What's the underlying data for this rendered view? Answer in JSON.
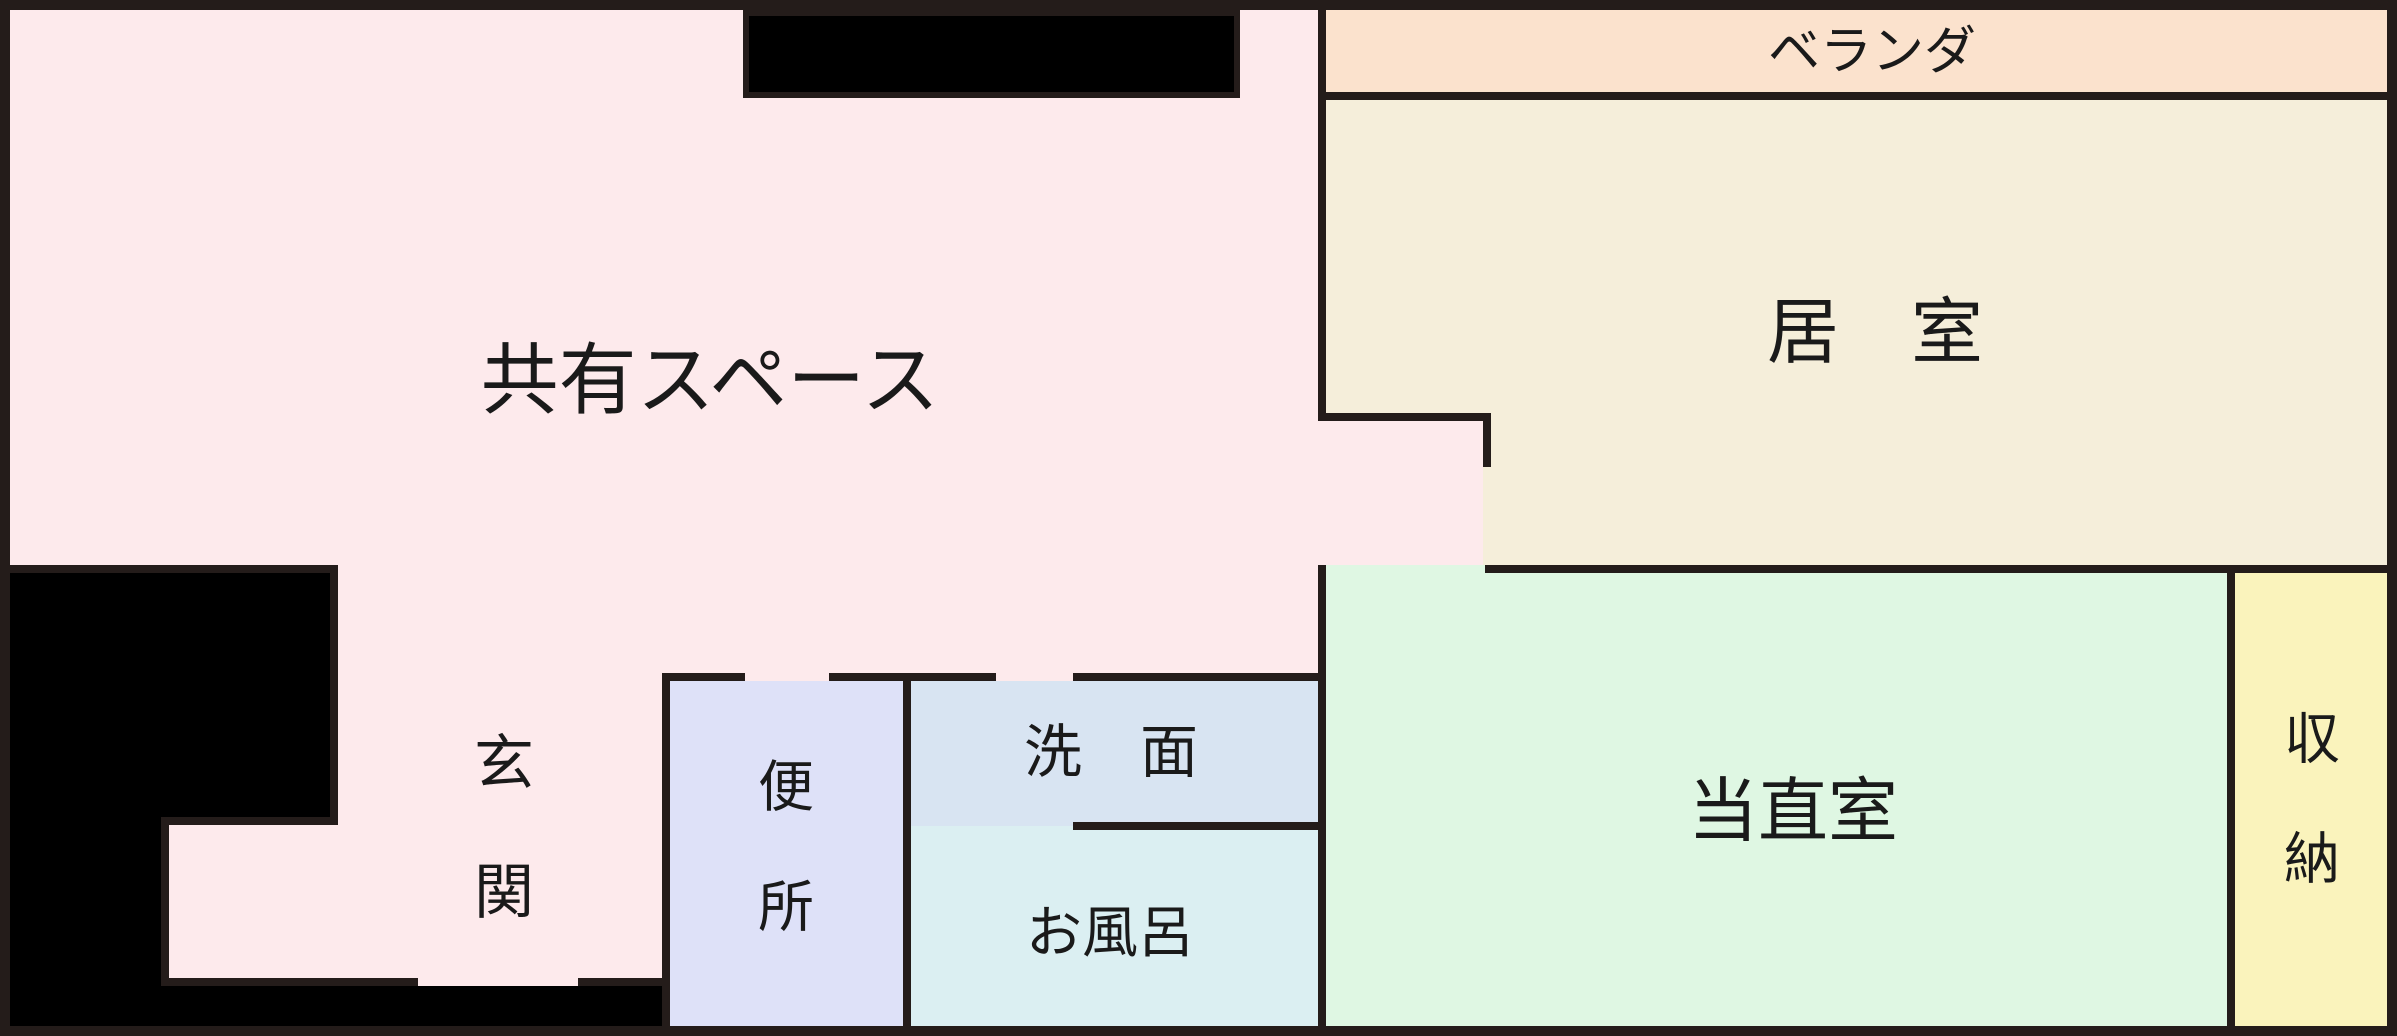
{
  "plan_title": "floor-plan",
  "rooms": {
    "shared_space": {
      "label": "共有スペース",
      "color": "#fdeaec"
    },
    "veranda": {
      "label": "ベランダ",
      "color": "#fbe2cd"
    },
    "living_room": {
      "label": "居　室",
      "color": "#f5eeda"
    },
    "duty_room": {
      "label": "当直室",
      "color": "#dff7e3"
    },
    "storage": {
      "label": "収納",
      "color": "#faf3bc"
    },
    "entrance": {
      "label": "玄関",
      "color": "#fdeaec"
    },
    "toilet": {
      "label": "便所",
      "color": "#dee1f8"
    },
    "washroom": {
      "label": "洗　面",
      "color": "#d8e4f2"
    },
    "bath": {
      "label": "お風呂",
      "color": "#dbeff2"
    }
  },
  "colors": {
    "wall": "#241c1a",
    "outside": "#000000",
    "text": "#1a1a1a"
  }
}
